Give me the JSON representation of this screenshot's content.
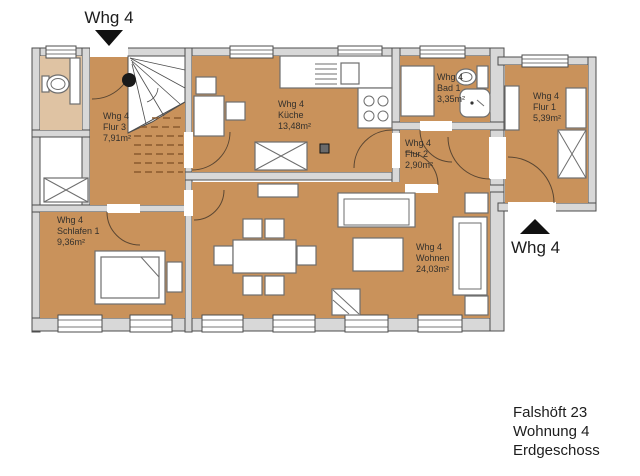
{
  "plan": {
    "entrances": {
      "top_label": "Whg 4",
      "side_label": "Whg 4"
    },
    "rooms": {
      "flur3": {
        "unit": "Whg 4",
        "name": "Flur 3",
        "area": "7,91m²"
      },
      "kueche": {
        "unit": "Whg 4",
        "name": "Küche",
        "area": "13,48m²"
      },
      "bad1": {
        "unit": "Whg 4",
        "name": "Bad 1",
        "area": "3,35m²"
      },
      "flur2": {
        "unit": "Whg 4",
        "name": "Flur 2",
        "area": "2,90m²"
      },
      "flur1": {
        "unit": "Whg 4",
        "name": "Flur 1",
        "area": "5,39m²"
      },
      "schlafen1": {
        "unit": "Whg 4",
        "name": "Schlafen 1",
        "area": "9,36m²"
      },
      "wohnen": {
        "unit": "Whg 4",
        "name": "Wohnen",
        "area": "24,03m²"
      }
    },
    "footer": {
      "address": "Falshöft 23",
      "apartment": "Wohnung 4",
      "floor": "Erdgeschoss"
    },
    "colors": {
      "room_fill": "#c9925b",
      "neighbor_fill": "#dfc3a3",
      "wall_fill": "#d8d8d8",
      "wall_stroke": "#4d4d4d",
      "arrow_fill": "#111111"
    }
  }
}
